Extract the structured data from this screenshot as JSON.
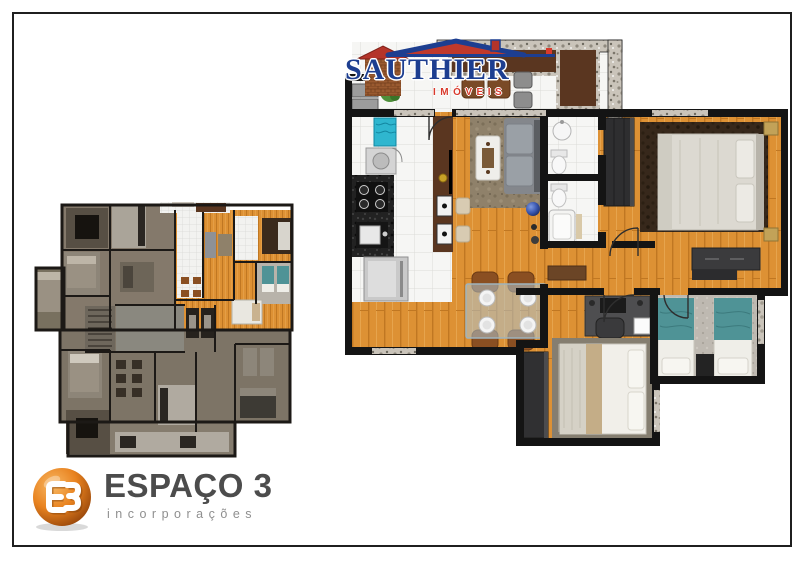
{
  "palette": {
    "frame": "#1f1f1f",
    "wall": "#141414",
    "wood": "#dd9134",
    "tile": "#f6f6f4",
    "granite": "#cac4ba",
    "counter_wood": "#5a3620",
    "teal": "#4f9396",
    "logo_blue": "#1d3e90",
    "logo_red": "#d83a2c",
    "logo_dark_gray": "#4c4c4c",
    "logo_light_gray": "#8f8f8f",
    "logo_orange": "#e07a1e",
    "small_floor": "#84796b"
  },
  "sauthier_logo": {
    "name": "SAUTHIER",
    "tagline": "IMÓVEIS"
  },
  "espaco_logo": {
    "name": "ESPAÇO 3",
    "tagline": "incorporações"
  }
}
